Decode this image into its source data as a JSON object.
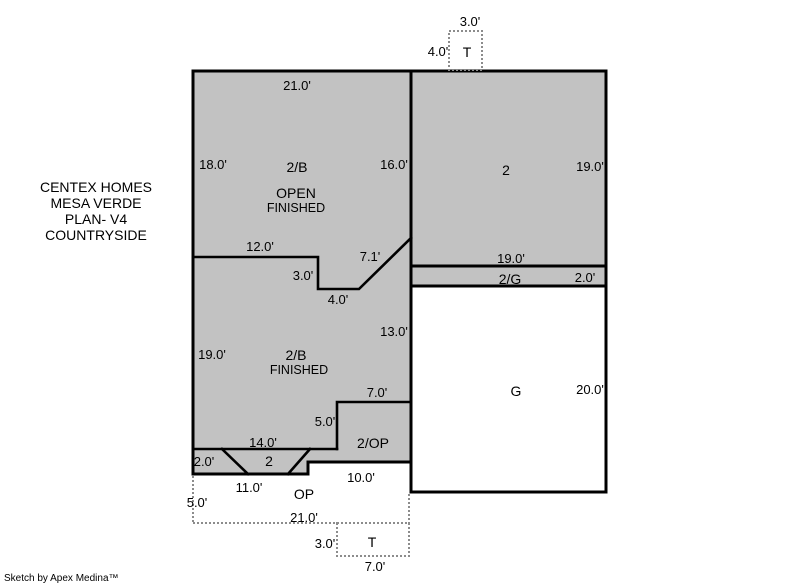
{
  "title_block": {
    "lines": [
      "CENTEX HOMES",
      "MESA VERDE",
      "PLAN- V4",
      "COUNTRYSIDE"
    ]
  },
  "credit": "Sketch by Apex Medina™",
  "colors": {
    "area_fill": "#c2c2c2",
    "outline": "#000000",
    "dotted_line": "#8c8c8c",
    "background": "#ffffff"
  },
  "top_deck": {
    "label": "T",
    "width_dim": "3.0'",
    "height_dim": "4.0'"
  },
  "upper_basement": {
    "label": "2/B",
    "sub1": "OPEN",
    "sub2": "FINISHED",
    "top_dim": "21.0'",
    "left_dim": "18.0'",
    "right_dim": "16.0'"
  },
  "upper_right_story": {
    "label": "2",
    "right_dim": "19.0'",
    "bottom_dim": "19.0'"
  },
  "garage_strip": {
    "label": "2/G",
    "right_dim": "2.0'"
  },
  "garage": {
    "label": "G",
    "right_dim": "20.0'"
  },
  "mid_step": {
    "dim_12": "12.0'",
    "dim_3": "3.0'",
    "dim_4": "4.0'",
    "dim_71": "7.1'",
    "dim_13": "13.0'"
  },
  "lower_basement": {
    "label": "2/B",
    "sub1": "FINISHED",
    "left_dim": "19.0'",
    "dim_7": "7.0'",
    "dim_5": "5.0'",
    "dim_14": "14.0'"
  },
  "open_porch_upper": {
    "label": "2/OP",
    "bottom_dim": "10.0'"
  },
  "entry_strip": {
    "left_dim": "2.0'",
    "label": "2"
  },
  "open_porch": {
    "label": "OP",
    "dim_11": "11.0'",
    "dim_5": "5.0'",
    "dim_21": "21.0'"
  },
  "bottom_deck": {
    "label": "T",
    "left_dim": "3.0'",
    "bottom_dim": "7.0'"
  }
}
